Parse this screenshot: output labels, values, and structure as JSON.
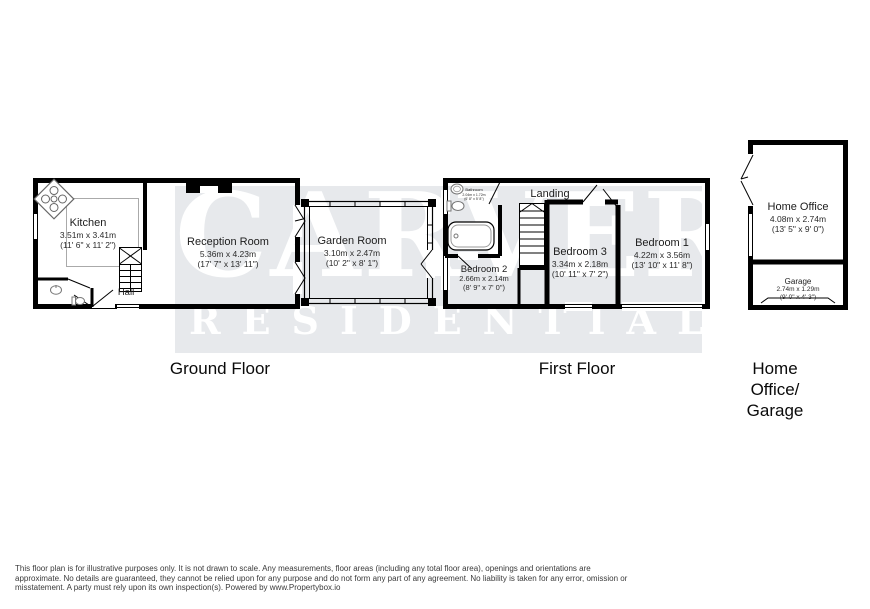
{
  "watermark": {
    "line1": "CARVER",
    "line2": "RESIDENTIAL",
    "band_color": "#e7e9ec",
    "text_color": "#ffffff"
  },
  "colors": {
    "wall": "#000000",
    "room_fill": "#ffffff",
    "fixture_stroke": "#777777",
    "counter_stroke": "#aaaaaa"
  },
  "rooms": {
    "kitchen": {
      "name": "Kitchen",
      "metric": "3.51m x 3.41m",
      "imperial": "(11' 6\" x 11' 2\")"
    },
    "reception": {
      "name": "Reception Room",
      "metric": "5.36m x 4.23m",
      "imperial": "(17' 7\" x 13' 11\")"
    },
    "garden": {
      "name": "Garden Room",
      "metric": "3.10m x 2.47m",
      "imperial": "(10' 2\" x 8' 1\")"
    },
    "hall": {
      "name": "Hall"
    },
    "landing": {
      "name": "Landing"
    },
    "bathroom": {
      "name": "Bathroom",
      "metric": "2.04m x 1.72m",
      "imperial": "(6' 8\" x 5' 8\")"
    },
    "bedroom1": {
      "name": "Bedroom 1",
      "metric": "4.22m x 3.56m",
      "imperial": "(13' 10\" x 11' 8\")"
    },
    "bedroom2": {
      "name": "Bedroom 2",
      "metric": "2.66m x 2.14m",
      "imperial": "(8' 9\" x 7' 0\")"
    },
    "bedroom3": {
      "name": "Bedroom 3",
      "metric": "3.34m x 2.18m",
      "imperial": "(10' 11\" x 7' 2\")"
    },
    "home_office": {
      "name": "Home Office",
      "metric": "4.08m x 2.74m",
      "imperial": "(13' 5\" x 9' 0\")"
    },
    "garage": {
      "name": "Garage",
      "metric": "2.74m x 1.29m",
      "imperial": "(9' 0\" x 4' 3\")"
    }
  },
  "floor_titles": {
    "ground": "Ground Floor",
    "first": "First Floor",
    "home_lines": [
      "Home",
      "Office/",
      "Garage"
    ]
  },
  "icons": {
    "kitchen_sink": "sink-hob-diamond",
    "bathtub": "bathtub",
    "toilet": "toilet",
    "basin": "basin",
    "stairs": "staircase-treads",
    "garage_door": "garage-door",
    "window": "double-line-window",
    "door": "door-leaf"
  },
  "disclaimer": {
    "lines": [
      "This floor plan is for illustrative purposes only. It is not drawn to scale. Any measurements, floor areas (including any total floor area), openings and orientations are",
      "approximate. No details are guaranteed, they cannot be relied upon for any purpose and do not form any part of any agreement. No liability is taken for any error, omission or",
      "misstatement. A party must rely upon its own inspection(s). Powered by www.Propertybox.io"
    ]
  }
}
